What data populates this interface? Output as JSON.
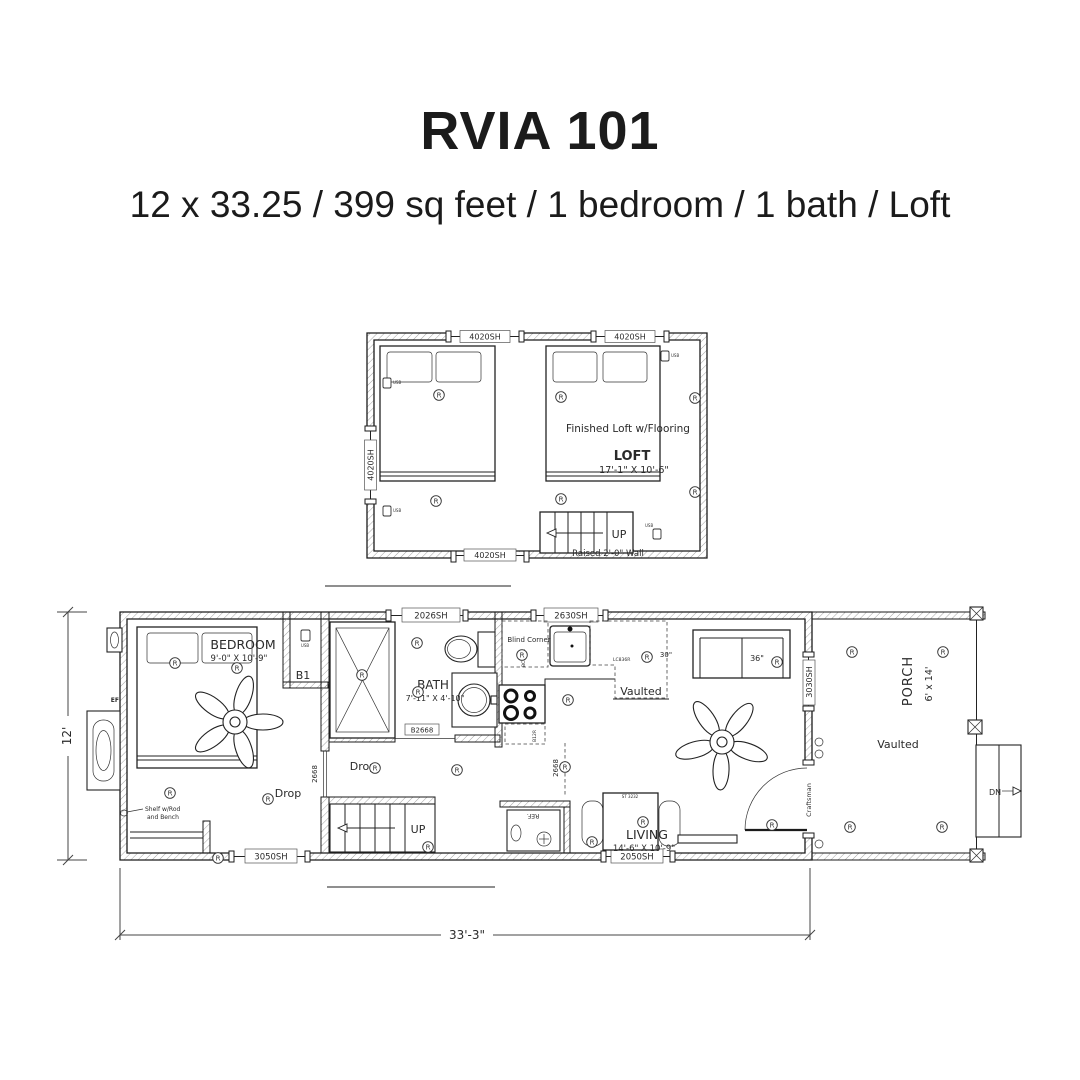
{
  "header": {
    "title": "RVIA 101",
    "subtitle": "12 x 33.25 / 399 sq feet / 1 bedroom / 1 bath / Loft"
  },
  "symbols": {
    "recessed_light": "R",
    "usb": "USB"
  },
  "loft": {
    "window_top_left": "4020SH",
    "window_top_right": "4020SH",
    "window_left": "4020SH",
    "window_bottom": "4020SH",
    "finished_label": "Finished Loft w/Flooring",
    "room_name": "LOFT",
    "room_dims": "17'-1\" X 10'-6\"",
    "up_label": "UP",
    "raised_wall_label": "Raised 2'-0\" Wall"
  },
  "main": {
    "bedroom_name": "BEDROOM",
    "bedroom_dims": "9'-0\" X 10'-9\"",
    "bath_name": "BATH",
    "bath_dims": "7'-11\" X 4'-10\"",
    "living_name": "LIVING",
    "living_dims": "14'-6\" X 10'-9\"",
    "porch_name": "PORCH",
    "porch_dims": "6' x 14'",
    "b1_label": "B1",
    "drop_bedroom": "Drop",
    "drop_hall": "Drop",
    "vaulted_kitchen": "Vaulted",
    "vaulted_porch": "Vaulted",
    "blind_corner": "Blind Corner",
    "shelf_line1": "Shelf w/Rod",
    "shelf_line2": "and Bench",
    "up_label": "UP",
    "dn_label": "DN",
    "ref_label": "REF.",
    "craftsman_label": "Craftsman",
    "ef_label": "EF",
    "sofa_width": "36\"",
    "cab_width": "30\"",
    "cab_lc": "LC836R",
    "cab_bc": "BC836R",
    "cab_b12": "B12R",
    "table_label": "ST 3232",
    "door_hall": "2668",
    "door_kitchen": "2668",
    "door_bath": "B2668",
    "win_2026": "2026SH",
    "win_2630": "2630SH",
    "win_3050": "3050SH",
    "win_2050": "2050SH",
    "win_3030": "3030SH",
    "dim_width": "12'",
    "dim_length": "33'-3\""
  }
}
